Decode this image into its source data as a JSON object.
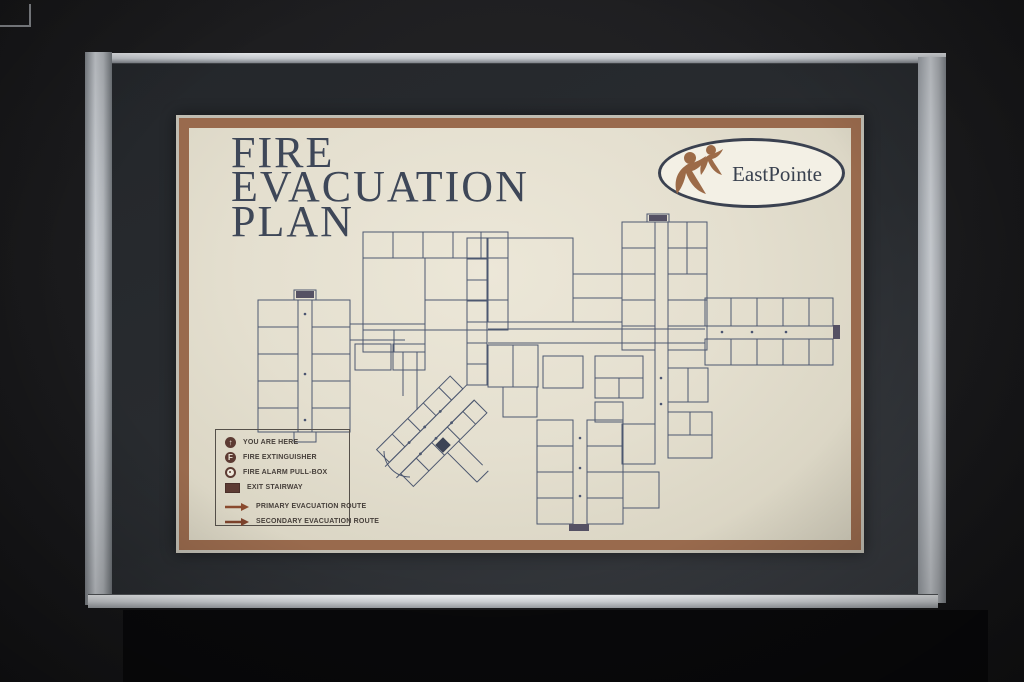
{
  "sign": {
    "title_lines": [
      "FIRE",
      "EVACUATION",
      "PLAN"
    ],
    "logo": {
      "text": "EastPointe"
    },
    "legend": {
      "items": [
        {
          "name": "you-are-here",
          "label": "YOU ARE HERE",
          "glyph": "↑"
        },
        {
          "name": "fire-extinguisher",
          "label": "FIRE EXTINGUISHER",
          "glyph": "F"
        },
        {
          "name": "fire-alarm-pull-box",
          "label": "FIRE ALARM PULL-BOX"
        },
        {
          "name": "exit-stairway",
          "label": "EXIT STAIRWAY"
        },
        {
          "name": "primary-evacuation-route",
          "label": "PRIMARY EVACUATION ROUTE"
        },
        {
          "name": "secondary-evacuation-route",
          "label": "SECONDARY EVACUATION ROUTE"
        }
      ]
    }
  },
  "colors": {
    "wall": "#1c1c1e",
    "frame_silver": "#c9cdd2",
    "mat": "#2a2d31",
    "sign_border_brown": "#996a4d",
    "sign_paper": "#e6e1d1",
    "title_text": "#3e4758",
    "plan_lines": "#4d5870",
    "legend_icons": "#5d3b33",
    "route_arrows": "#8a4a2e",
    "logo_figures": "#9c6b48",
    "counter_black": "#09090b"
  }
}
